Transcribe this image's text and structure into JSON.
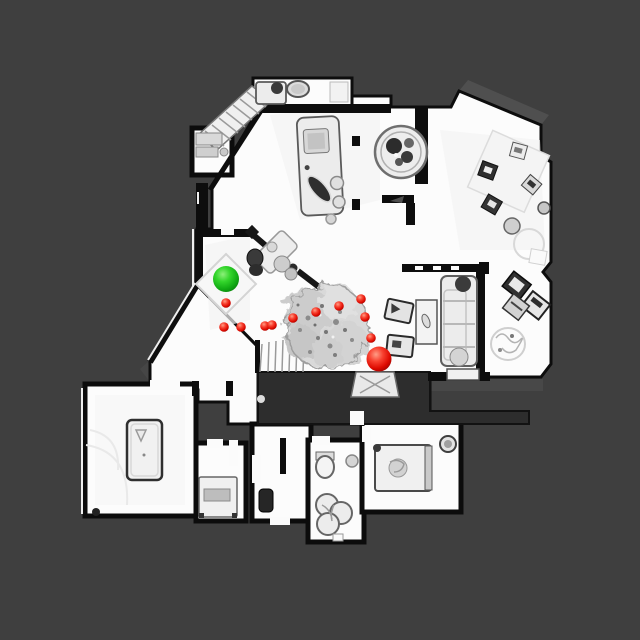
{
  "scene": {
    "description": "top-down 3D scan floor plan with navigation path",
    "background_color": "#3f3f3f",
    "floor_color": "#fcfcfc",
    "wall_color": "#0d0d0d",
    "markers": {
      "start": {
        "label": "start-point",
        "x": 226,
        "y": 279,
        "r": 13,
        "gradient": [
          "#8df07a",
          "#34d62c",
          "#12ac14",
          "#077a08"
        ]
      },
      "goal": {
        "label": "goal-point",
        "x": 379,
        "y": 359,
        "r": 12.5,
        "gradient": [
          "#ff9d86",
          "#f84130",
          "#dd0a00",
          "#8c0200"
        ]
      },
      "waypoints": {
        "r": 4.8,
        "gradient": [
          "#ff9d86",
          "#f84130",
          "#dd0a00",
          "#8c0200"
        ],
        "points": [
          [
            226,
            303
          ],
          [
            224,
            327
          ],
          [
            241,
            327
          ],
          [
            265,
            326
          ],
          [
            272,
            325
          ],
          [
            293,
            318
          ],
          [
            316,
            312
          ],
          [
            339,
            306
          ],
          [
            361,
            299
          ],
          [
            365,
            317
          ],
          [
            371,
            338
          ]
        ]
      }
    }
  }
}
